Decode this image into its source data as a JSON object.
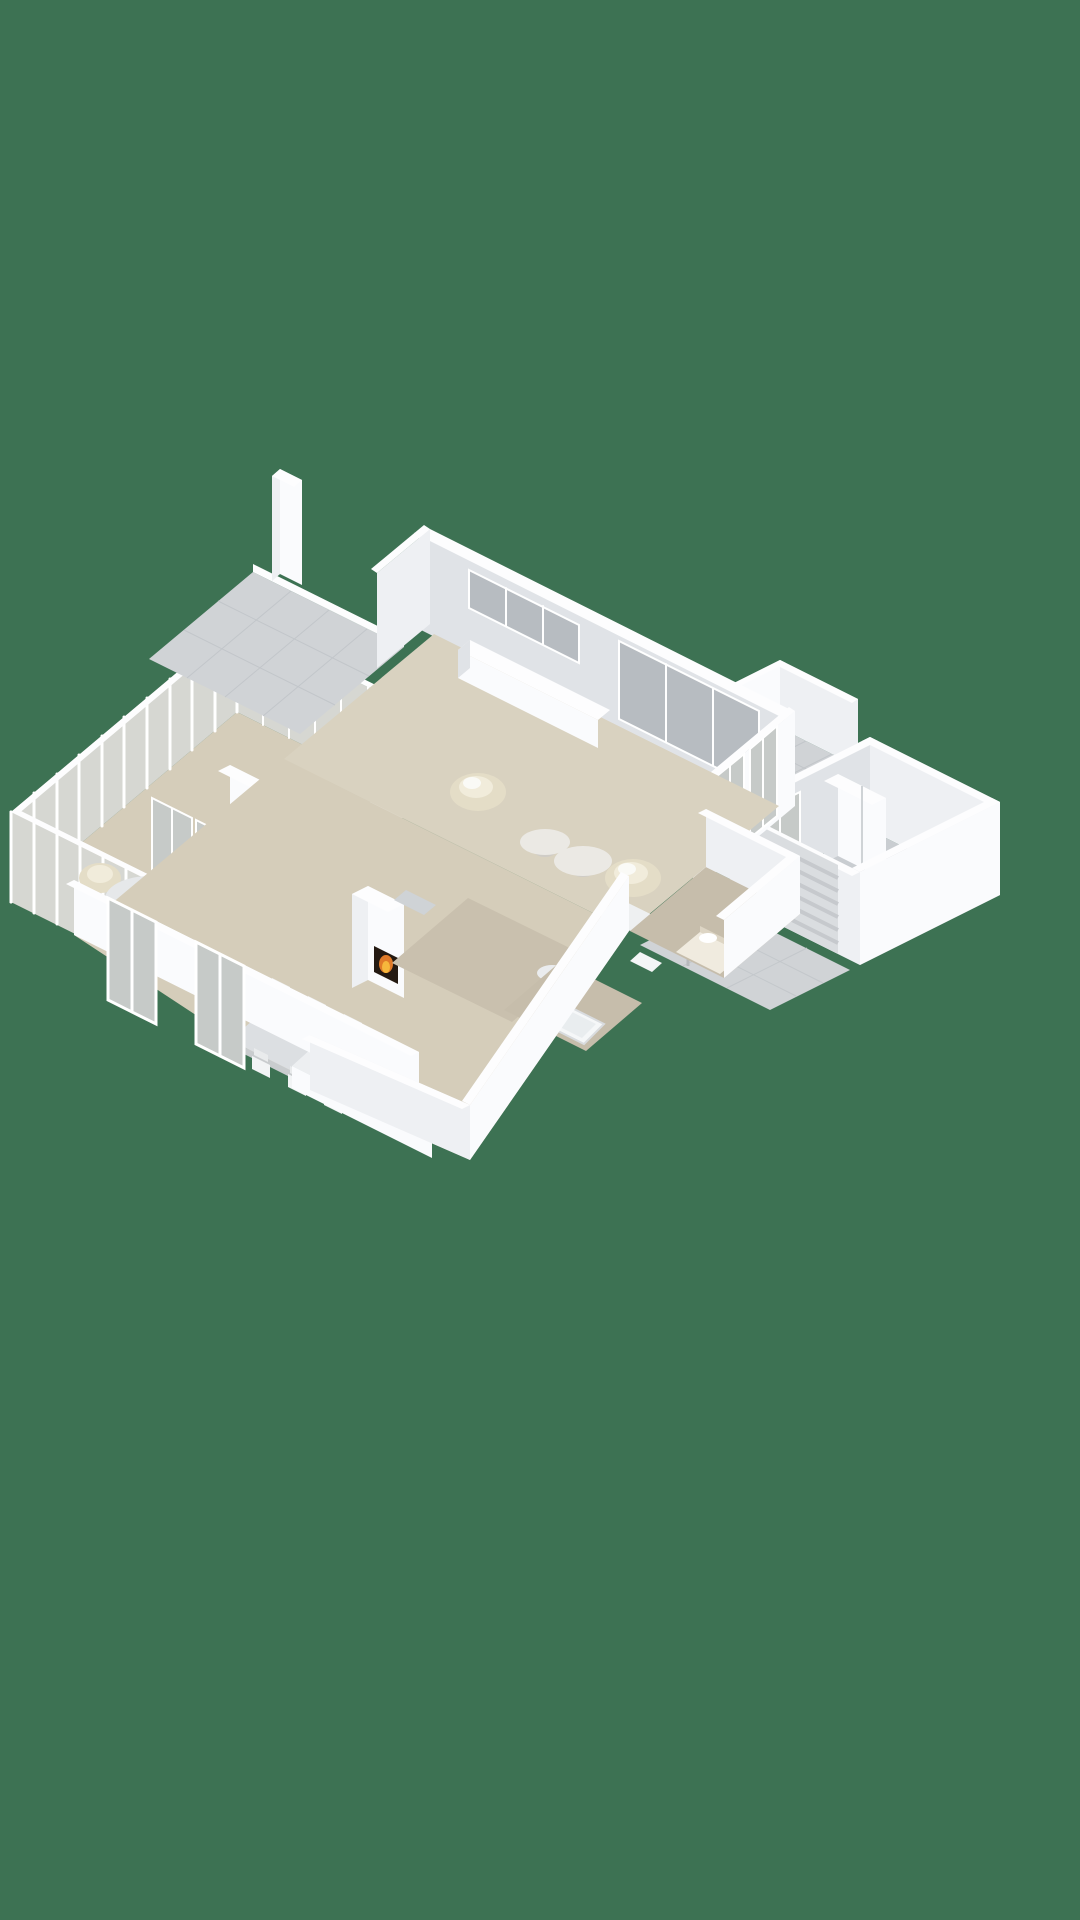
{
  "scene": {
    "type": "isometric-3d-floor-plan",
    "view": "bird's-eye cutaway render, single floor, no text labels"
  },
  "palette": {
    "background": "#3d7253",
    "floor_main": "#d9d2c0",
    "floor_wing": "#d5cdba",
    "floor_taupe": "#c9c0ae",
    "floor_taupe_dark": "#c6bdab",
    "tile": "#d0d3d6",
    "tile_line": "#c2c6ca",
    "garage_floor": "#c9cdd1",
    "wall_bright": "#fafbfd",
    "wall_mid": "#e0e3e7",
    "glass": "#c6cac8",
    "glass_window": "#b7bcc1",
    "conservatory_glass": "#d6d7d2",
    "cream": "#e4ddc7",
    "cream_light": "#f1ecdb",
    "wood": "#7a5a42",
    "marble": "#ebe9e4",
    "table_top": "#dcdfe2",
    "chair_white": "#f2f4f5",
    "cooktop_black": "#202224",
    "burner_red": "#c0392f",
    "flame_orange": "#e07a28",
    "flame_yellow": "#f6b73c",
    "firebox_dark": "#241a12",
    "accent_red": "#b23530",
    "niche_dark": "#4a4038",
    "door_slat": "#c6c9cd",
    "garage_door": "#dadde0"
  },
  "rooms": {
    "living": {
      "label": "Living room"
    },
    "dining": {
      "label": "Dining area"
    },
    "kitchen": {
      "label": "Kitchen"
    },
    "hallway": {
      "label": "Hallway"
    },
    "bathroom": {
      "label": "Bathroom"
    },
    "bedroom": {
      "label": "Bedroom"
    },
    "conservatory": {
      "label": "Conservatory"
    },
    "patio": {
      "label": "Patio"
    },
    "terrace": {
      "label": "Terrace"
    },
    "garage": {
      "label": "Garage"
    },
    "driveway": {
      "label": "Driveway"
    }
  }
}
